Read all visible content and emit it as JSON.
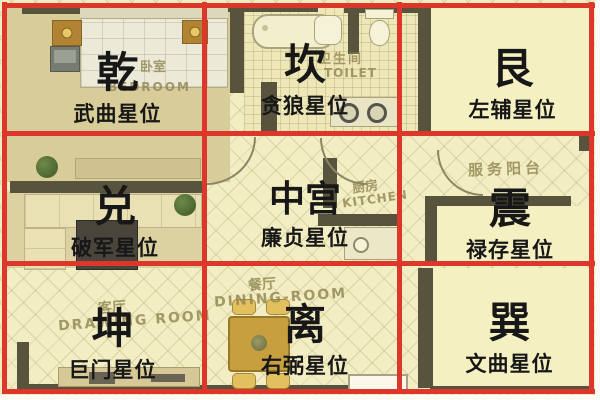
{
  "palette": {
    "grid_red": "#dc372a",
    "wall_dark": "#57533d",
    "floor_cream": "#f2edc2",
    "floor_khaki": "#d8cd99",
    "floor_pale": "#f5f0c2",
    "wood_gold": "#c79f3e",
    "plant_green": "#54703a",
    "label_black": "#171717",
    "watermark_olive": "#8f8551"
  },
  "cells": [
    {
      "id": "qian",
      "row": 0,
      "col": 0,
      "trigram": "乾",
      "star": "武曲星位"
    },
    {
      "id": "kan",
      "row": 0,
      "col": 1,
      "trigram": "坎",
      "star": "贪狼星位"
    },
    {
      "id": "gen",
      "row": 0,
      "col": 2,
      "trigram": "艮",
      "star": "左辅星位"
    },
    {
      "id": "dui",
      "row": 1,
      "col": 0,
      "trigram": "兑",
      "star": "破军星位"
    },
    {
      "id": "zhonggong",
      "row": 1,
      "col": 1,
      "trigram": "中宫",
      "star": "廉贞星位"
    },
    {
      "id": "zhen",
      "row": 1,
      "col": 2,
      "trigram": "震",
      "star": "禄存星位"
    },
    {
      "id": "kun",
      "row": 2,
      "col": 0,
      "trigram": "坤",
      "star": "巨门星位"
    },
    {
      "id": "li",
      "row": 2,
      "col": 1,
      "trigram": "离",
      "star": "右弼星位"
    },
    {
      "id": "xun",
      "row": 2,
      "col": 2,
      "trigram": "巽",
      "star": "文曲星位"
    }
  ],
  "rooms": {
    "bedroom": {
      "zh": "卧室",
      "en": "BEDROOM"
    },
    "toilet": {
      "zh": "卫生间",
      "en": "TOILET"
    },
    "kitchen": {
      "zh": "厨房",
      "en": "KITCHEN"
    },
    "service_balcony": {
      "zh": "服务阳台"
    },
    "drawing_room": {
      "zh": "客厅",
      "en": "DRAWING ROOM"
    },
    "dining_room": {
      "zh": "餐厅",
      "en": "DINING-ROOM"
    }
  }
}
